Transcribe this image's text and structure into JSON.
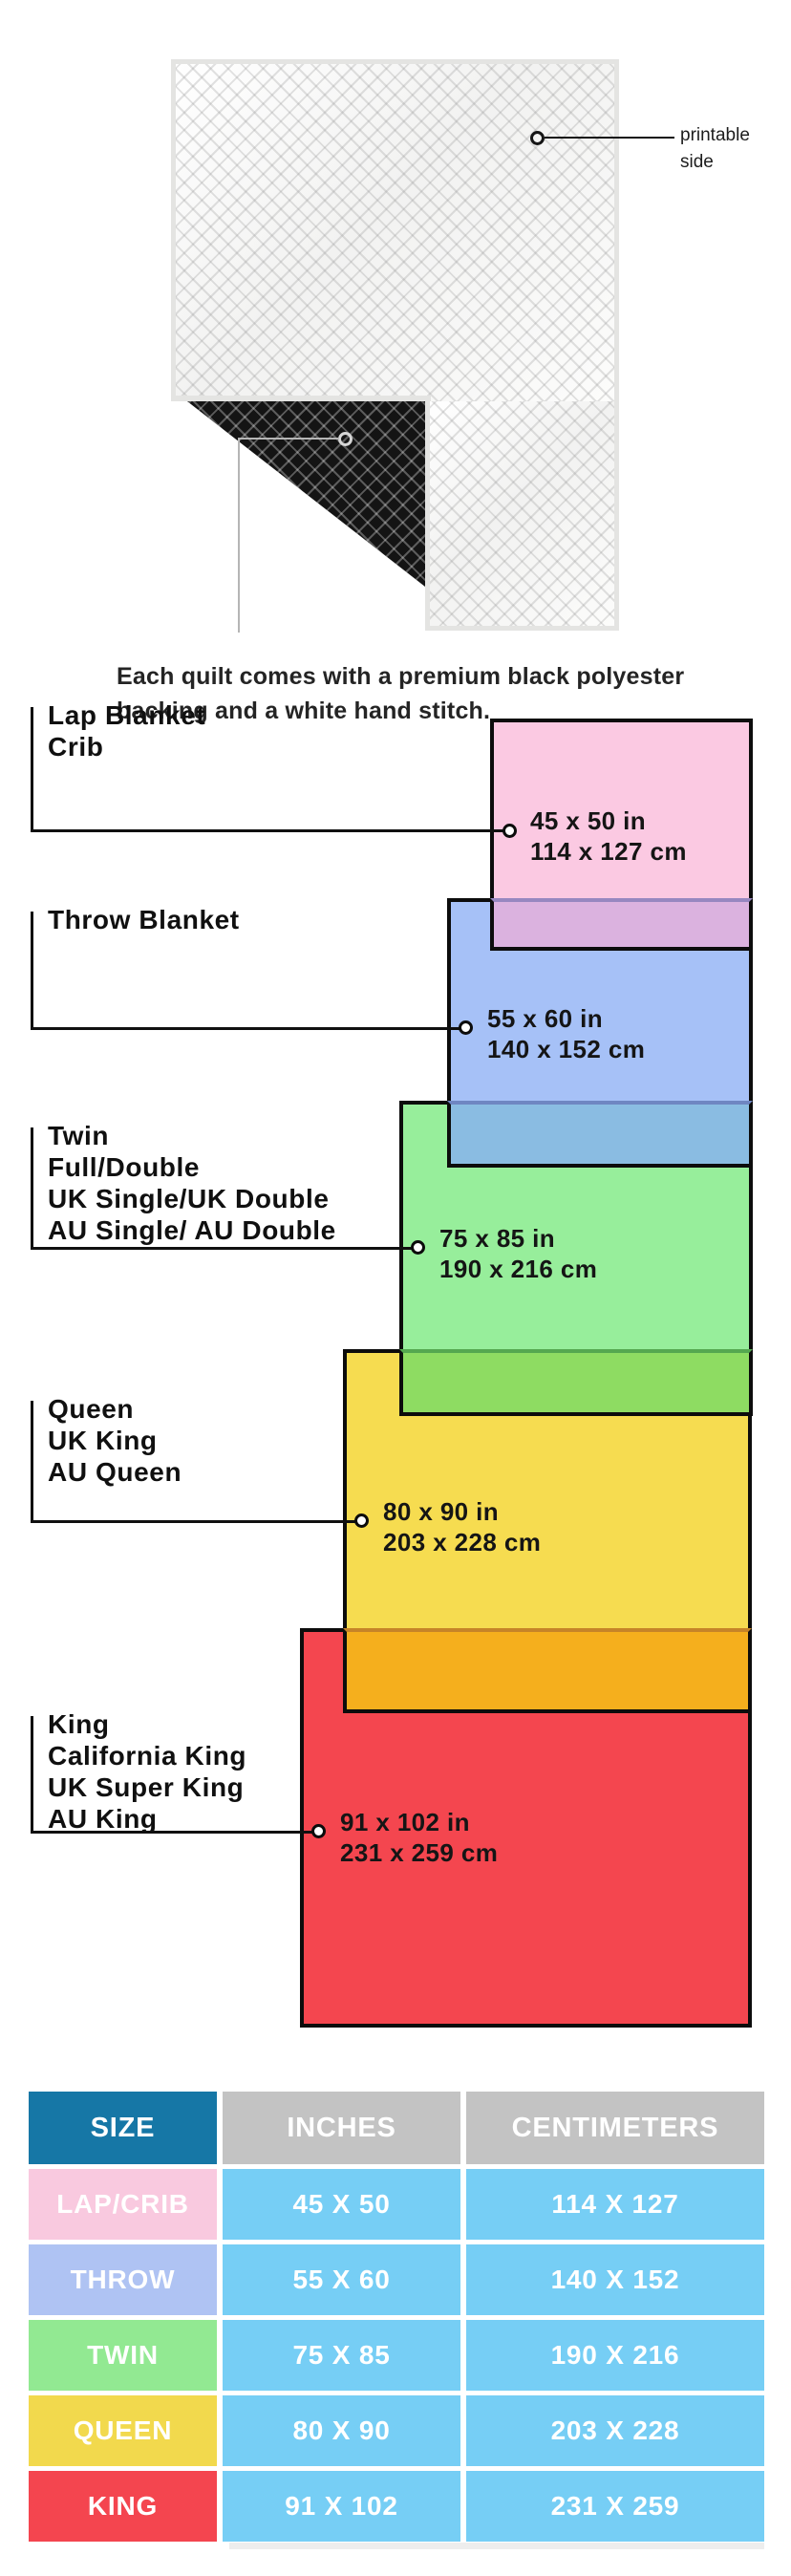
{
  "intro": {
    "printable_label_line1": "printable",
    "printable_label_line2": "side",
    "caption_line1": "Each quilt comes with a premium black polyester",
    "caption_line2": "backing and a white hand stitch."
  },
  "diagram": {
    "items": [
      {
        "id": "lap",
        "labels": [
          "Lap Blanket",
          "Crib"
        ],
        "inches": "45 x 50 in",
        "cm": "114 x 127 cm",
        "fill": "#FBC9E2",
        "overlap_fill": "#DBB2DF"
      },
      {
        "id": "throw",
        "labels": [
          "Throw Blanket"
        ],
        "inches": "55 x 60 in",
        "cm": "140 x 152 cm",
        "fill": "#A6C1F7",
        "overlap_fill": "#8ABCE2"
      },
      {
        "id": "twin",
        "labels": [
          "Twin",
          "Full/Double",
          "UK Single/UK Double",
          "AU Single/ AU Double"
        ],
        "inches": "75 x 85 in",
        "cm": "190 x 216 cm",
        "fill": "#97EE9B",
        "overlap_fill": "#8EDC62"
      },
      {
        "id": "queen",
        "labels": [
          "Queen",
          "UK King",
          "AU Queen"
        ],
        "inches": "80 x 90 in",
        "cm": "203 x 228 cm",
        "fill": "#F6DC50",
        "overlap_fill": "#F5AF1D"
      },
      {
        "id": "king",
        "labels": [
          "King",
          "California King",
          "UK Super King",
          "AU King"
        ],
        "inches": "91 x 102 in",
        "cm": "231 x 259 cm",
        "fill": "#F4464F",
        "overlap_fill": ""
      }
    ]
  },
  "table": {
    "headers": [
      "SIZE",
      "INCHES",
      "CENTIMETERS"
    ],
    "rows": [
      {
        "size": "LAP/CRIB",
        "inches": "45 X 50",
        "cm": "114 X 127",
        "label_color": "#F9C9DF"
      },
      {
        "size": "THROW",
        "inches": "55 X 60",
        "cm": "140 X 152",
        "label_color": "#AFC3F3"
      },
      {
        "size": "TWIN",
        "inches": "75 X 85",
        "cm": "190 X 216",
        "label_color": "#92E992"
      },
      {
        "size": "QUEEN",
        "inches": "80 X 90",
        "cm": "203 X 228",
        "label_color": "#F2D94D"
      },
      {
        "size": "KING",
        "inches": "91 X 102",
        "cm": "231 X 259",
        "label_color": "#F4454F"
      }
    ],
    "colors": {
      "header_teal": "#1677A6",
      "header_grey": "#C3C3C3",
      "cell_blue": "#76CEF5"
    }
  }
}
